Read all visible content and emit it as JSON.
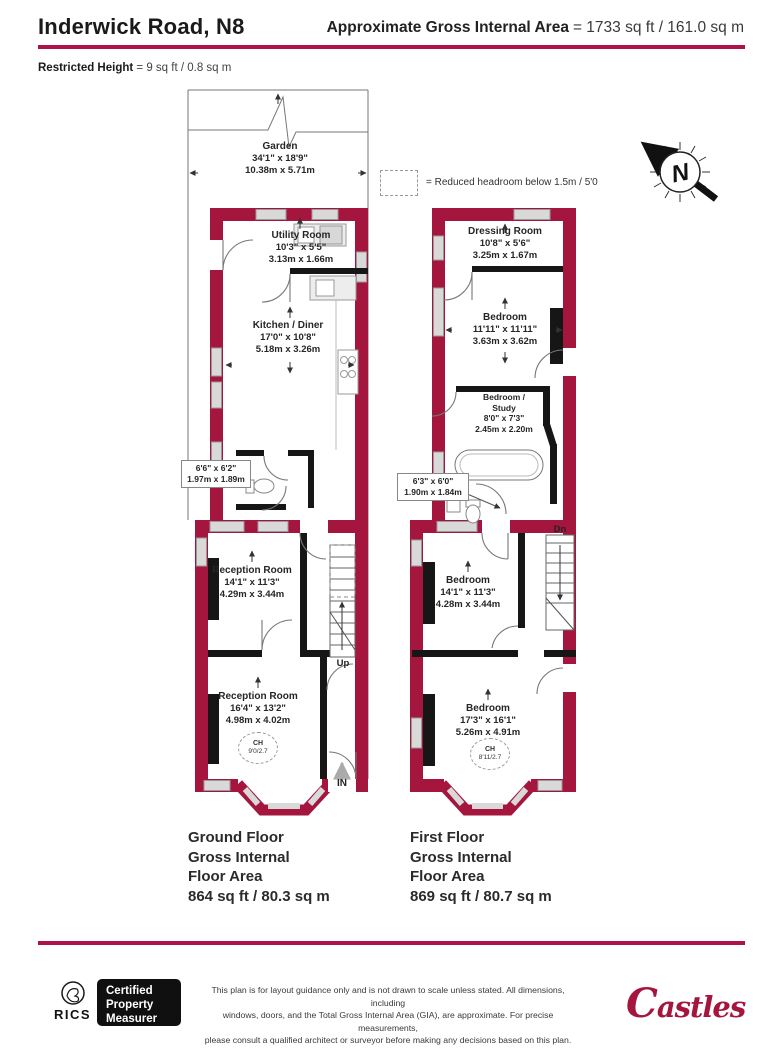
{
  "header": {
    "title": "Inderwick Road, N8",
    "gia_label": "Approximate Gross Internal Area",
    "gia_value": "= 1733 sq ft / 161.0 sq m",
    "restricted_label": "Restricted Height",
    "restricted_value": "= 9 sq ft / 0.8 sq m"
  },
  "colors": {
    "wall": "#A5163F",
    "accent_rule": "#AE124C",
    "interior_wall": "#161616",
    "window": "#D9D9D9"
  },
  "legend": {
    "text": "= Reduced headroom below 1.5m / 5'0"
  },
  "compass": {
    "n": "N"
  },
  "garden": {
    "name": "Garden",
    "imperial": "34'1\" x 18'9\"",
    "metric": "10.38m x 5.71m"
  },
  "gf": {
    "utility": {
      "name": "Utility Room",
      "imp": "10'3\" x 5'5\"",
      "met": "3.13m x 1.66m"
    },
    "kitchen": {
      "name": "Kitchen / Diner",
      "imp": "17'0\" x 10'8\"",
      "met": "5.18m x 3.26m"
    },
    "wc": {
      "imp": "6'6\" x 6'2\"",
      "met": "1.97m x 1.89m"
    },
    "reception1": {
      "name": "Reception Room",
      "imp": "14'1\" x 11'3\"",
      "met": "4.29m x 3.44m"
    },
    "reception2": {
      "name": "Reception Room",
      "imp": "16'4\" x 13'2\"",
      "met": "4.98m x 4.02m"
    },
    "ch": {
      "label": "CH",
      "value": "9'0/2.7"
    },
    "up": "Up",
    "in_label": "IN",
    "area": [
      "Ground Floor",
      "Gross Internal",
      "Floor Area",
      "864 sq ft / 80.3 sq m"
    ]
  },
  "ff": {
    "dressing": {
      "name": "Dressing Room",
      "imp": "10'8\" x 5'6\"",
      "met": "3.25m x 1.67m"
    },
    "bedroom1": {
      "name": "Bedroom",
      "imp": "11'11\" x 11'11\"",
      "met": "3.63m x 3.62m"
    },
    "study": {
      "l1": "Bedroom /",
      "l2": "Study",
      "imp": "8'0\" x 7'3\"",
      "met": "2.45m x 2.20m"
    },
    "bath": {
      "imp": "6'3\" x 6'0\"",
      "met": "1.90m x 1.84m"
    },
    "bedroom2": {
      "name": "Bedroom",
      "imp": "14'1\" x 11'3\"",
      "met": "4.28m x 3.44m"
    },
    "bedroom3": {
      "name": "Bedroom",
      "imp": "17'3\" x 16'1\"",
      "met": "5.26m x 4.91m"
    },
    "ch": {
      "label": "CH",
      "value": "8'11/2.7"
    },
    "dn": "Dn",
    "area": [
      "First Floor",
      "Gross Internal",
      "Floor Area",
      "869 sq ft / 80.7 sq m"
    ]
  },
  "footer": {
    "rics": "RICS",
    "badge_lines": [
      "Certified",
      "Property",
      "Measurer"
    ],
    "disclaimer_lines": [
      "This plan is for layout guidance only and is not drawn to scale unless stated. All dimensions, including",
      "windows, doors, and the Total Gross Internal Area (GIA), are approximate. For precise measurements,",
      "please consult a qualified architect or surveyor before making any decisions based on this plan."
    ],
    "brand": "Castles"
  }
}
